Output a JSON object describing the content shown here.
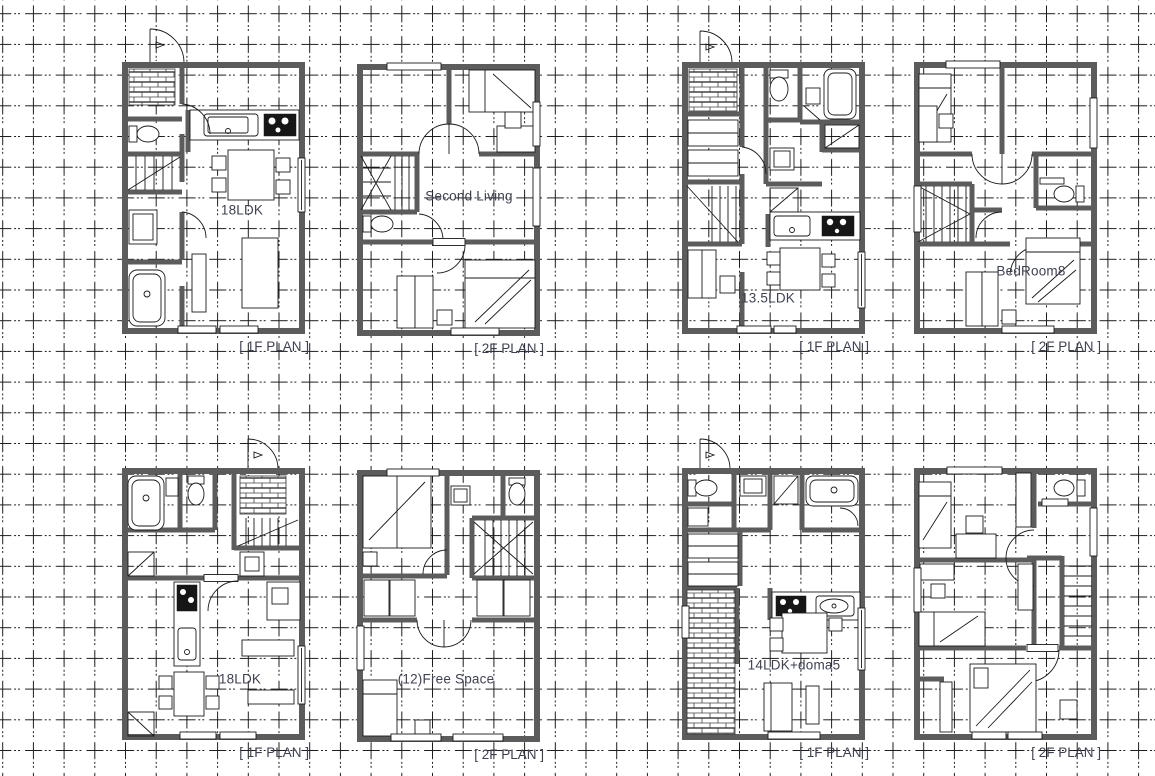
{
  "page": {
    "background": "#ffffff",
    "grid_color": "#1c1c1c",
    "wall_color": "#5c5c5c",
    "fixture_line_color": "#1a1a1a",
    "label_color": "#3e4154"
  },
  "plans": [
    {
      "id": "plan-a-1f",
      "room_label": "18LDK",
      "caption": "[ 1F PLAN ]"
    },
    {
      "id": "plan-a-2f",
      "room_label": "Second Living",
      "caption": "[ 2F PLAN ]"
    },
    {
      "id": "plan-b-1f",
      "room_label": "13.5LDK",
      "caption": "[ 1F PLAN ]"
    },
    {
      "id": "plan-b-2f",
      "room_label": "BedRoom8",
      "caption": "[ 2F PLAN ]"
    },
    {
      "id": "plan-c-1f",
      "room_label": "18LDK",
      "caption": "[ 1F PLAN ]"
    },
    {
      "id": "plan-c-2f",
      "room_label": "(12)Free Space",
      "caption": "[ 2F PLAN ]"
    },
    {
      "id": "plan-d-1f",
      "room_label": "14LDK+doma5",
      "caption": "[ 1F PLAN ]"
    },
    {
      "id": "plan-d-2f",
      "room_label": "",
      "caption": "[ 2F PLAN ]"
    }
  ]
}
